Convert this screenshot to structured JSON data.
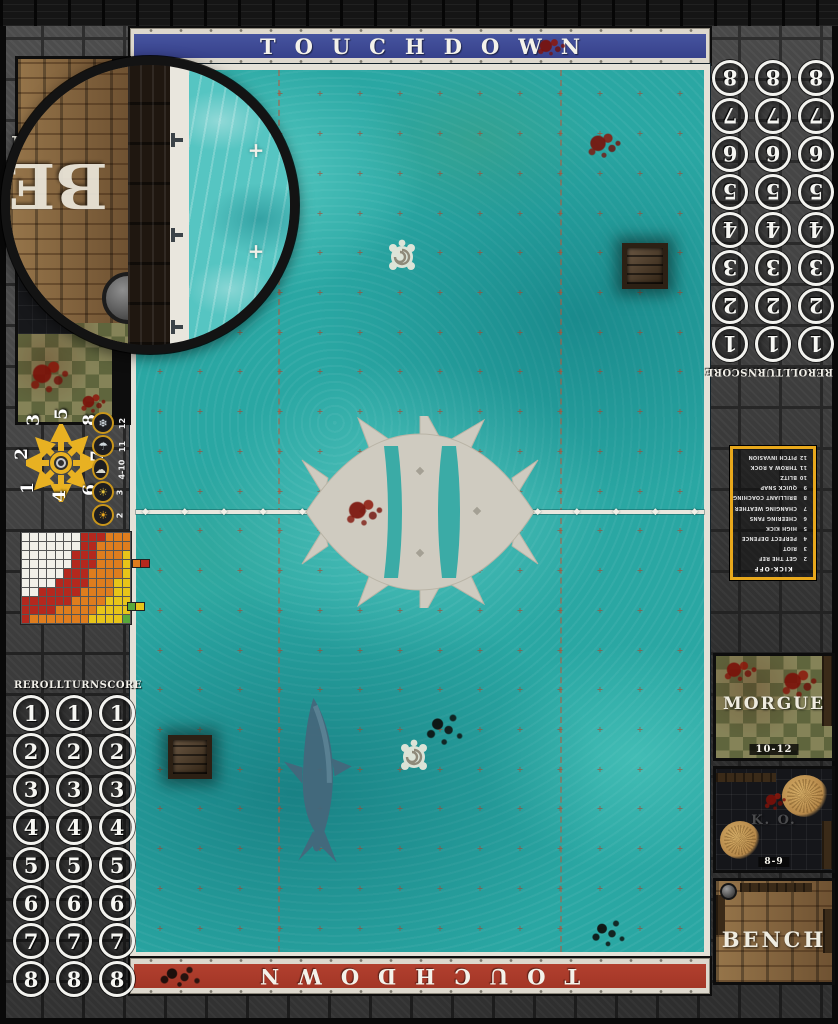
{
  "mat": {
    "colors": {
      "banner_blue": "#3e4a9b",
      "banner_red": "#b23a2a",
      "accent_yellow": "#e8a81c",
      "field_teal": "#2aa7a3",
      "stone_gray": "#404040"
    },
    "banners": {
      "top_text": "TOUCHDOWN",
      "bottom_text": "TOUCHDOWN"
    },
    "turn_track": {
      "labels": [
        "REROLL",
        "TURN",
        "SCORE"
      ],
      "numbers": [
        "1",
        "2",
        "3",
        "4",
        "5",
        "6",
        "7",
        "8"
      ],
      "columns": 3
    },
    "scatter_dial": {
      "grid": [
        "3",
        "5",
        "8",
        "2",
        "7",
        "1",
        "4",
        "6"
      ]
    },
    "weather_track": {
      "items": [
        {
          "value": "12",
          "icon": "blizzard-icon",
          "glyph": "❄",
          "color": "#e3ecf2"
        },
        {
          "value": "11",
          "icon": "rain-icon",
          "glyph": "☂",
          "color": "#ccd4d9"
        },
        {
          "value": "4-10",
          "icon": "cloudy-sun-icon",
          "glyph": "☁",
          "color": "#d9d9cd"
        },
        {
          "value": "3",
          "icon": "sunny-icon",
          "glyph": "☀",
          "color": "#e5c23c"
        },
        {
          "value": "2",
          "icon": "sweltering-sun-icon",
          "glyph": "☀",
          "color": "#f0ab1e"
        }
      ]
    },
    "kickoff_table": {
      "title": "KICK-OFF",
      "entries": [
        {
          "roll": "2",
          "result": "GET THE REF"
        },
        {
          "roll": "3",
          "result": "RIOT"
        },
        {
          "roll": "4",
          "result": "PERFECT DEFENCE"
        },
        {
          "roll": "5",
          "result": "HIGH KICK"
        },
        {
          "roll": "6",
          "result": "CHEERING FANS"
        },
        {
          "roll": "7",
          "result": "CHANGING WEATHER"
        },
        {
          "roll": "8",
          "result": "BRILLIANT COACHING"
        },
        {
          "roll": "9",
          "result": "QUICK SNAP"
        },
        {
          "roll": "10",
          "result": "BLITZ"
        },
        {
          "roll": "11",
          "result": "THROW A ROCK"
        },
        {
          "roll": "12",
          "result": "PITCH INVASION"
        }
      ]
    },
    "range_chart": {
      "cols": 13,
      "rows": 10,
      "bands": [
        {
          "color": "#f2f0e9",
          "max": 6.8
        },
        {
          "color": "#b4281e",
          "max": 9.6
        },
        {
          "color": "#df7d1e",
          "max": 12.6
        },
        {
          "color": "#e8c419",
          "max": 15.2
        },
        {
          "color": "#58a83c",
          "max": 99
        }
      ],
      "legend": [
        {
          "colors": [
            "#df7d1e",
            "#b4281e"
          ]
        },
        {
          "colors": [
            "#58a83c",
            "#e8c419"
          ]
        }
      ]
    },
    "dugouts": {
      "right": {
        "morgue": {
          "label": "MORGUE",
          "range": "10-12"
        },
        "ko": {
          "label": "K. O.",
          "range": "8-9"
        },
        "bench": {
          "label": "BENCH"
        }
      },
      "left": {
        "bench_label": "BENCH"
      }
    },
    "lens": {
      "bench_letters": "BE"
    },
    "field": {
      "marker_cols": 14,
      "marker_rows": 22,
      "centerline_diamonds": 15,
      "diamond_glyph": "◆",
      "marker_glyph": "+",
      "lens_plus_glyph": "+"
    }
  }
}
